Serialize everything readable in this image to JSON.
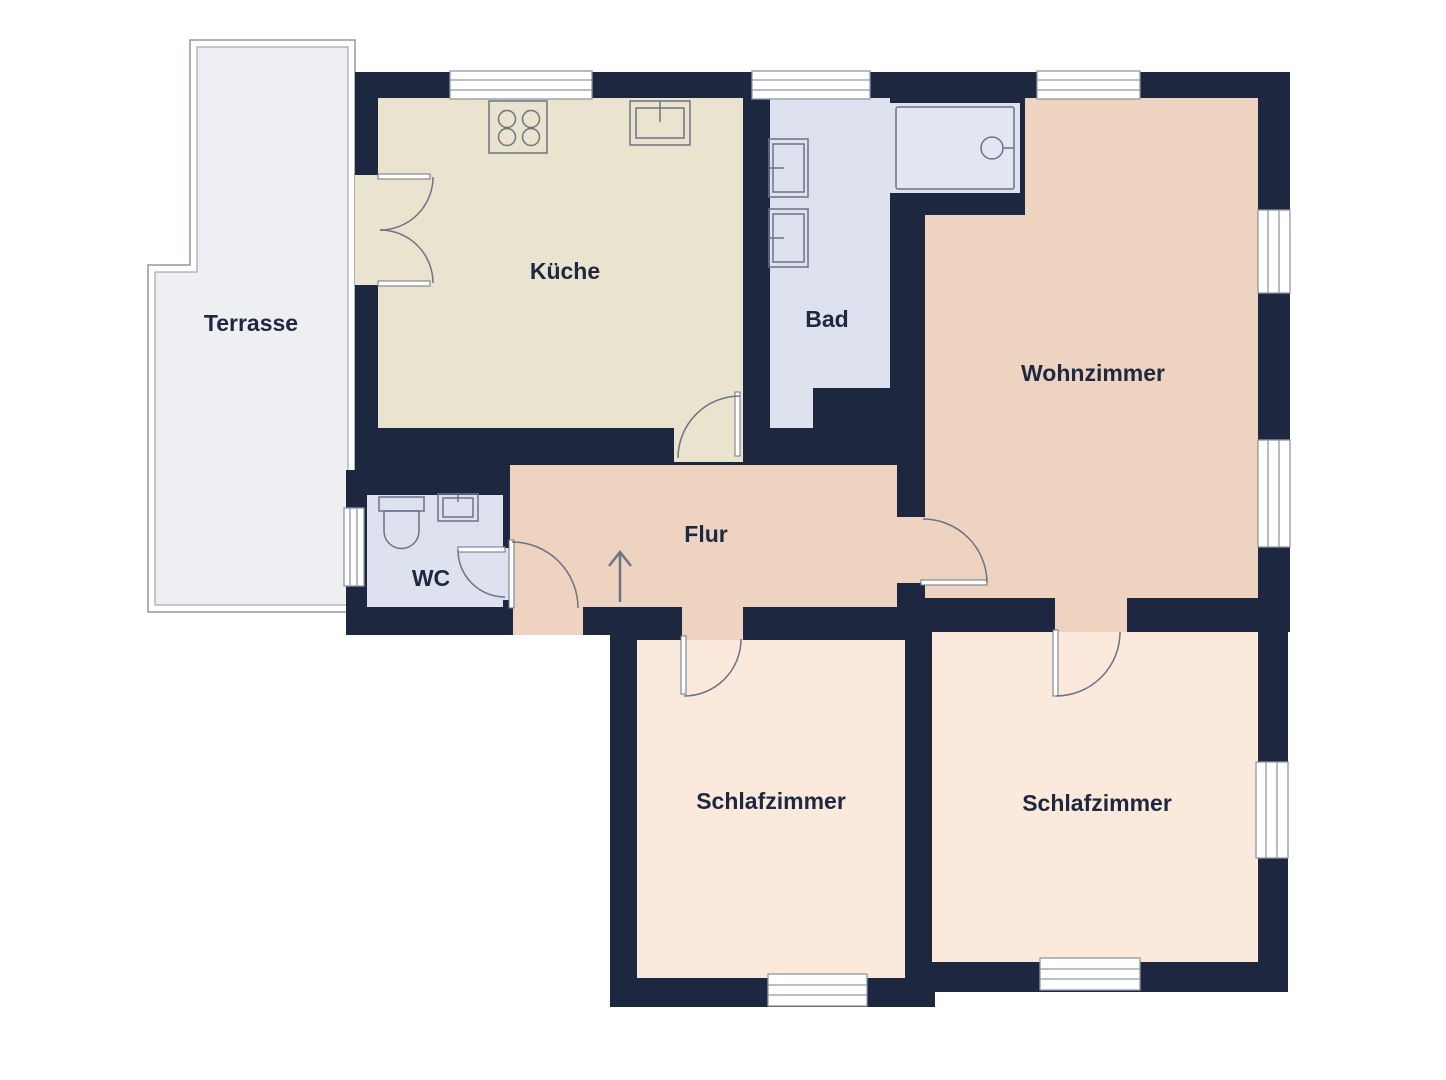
{
  "plan": {
    "type": "floorplan",
    "rooms": {
      "terrasse": {
        "label": "Terrasse"
      },
      "kueche": {
        "label": "Küche"
      },
      "bad": {
        "label": "Bad"
      },
      "wohnzimmer": {
        "label": "Wohnzimmer"
      },
      "flur": {
        "label": "Flur"
      },
      "wc": {
        "label": "WC"
      },
      "schlafzimmer_links": {
        "label": "Schlafzimmer"
      },
      "schlafzimmer_rechts": {
        "label": "Schlafzimmer"
      }
    },
    "fixtures": [
      "stove-icon",
      "kitchen-sink-icon",
      "bathroom-sink-icon",
      "bathroom-sink-icon",
      "bathtub-icon",
      "toilet-icon",
      "wc-sink-icon",
      "entrance-arrow-icon"
    ],
    "colors": {
      "wall": "#1d2840",
      "kitchen_floor": "#eae4cf",
      "bath_floor": "#dde2ee",
      "living_floor": "#eed3c1",
      "bedroom_floor": "#fbe9dc",
      "terrace_floor": "#edeff2",
      "bathtub": "#e2e6f2",
      "outline": "#9098a3",
      "fixture_line": "#6b7385",
      "label": "#1d2940"
    }
  }
}
